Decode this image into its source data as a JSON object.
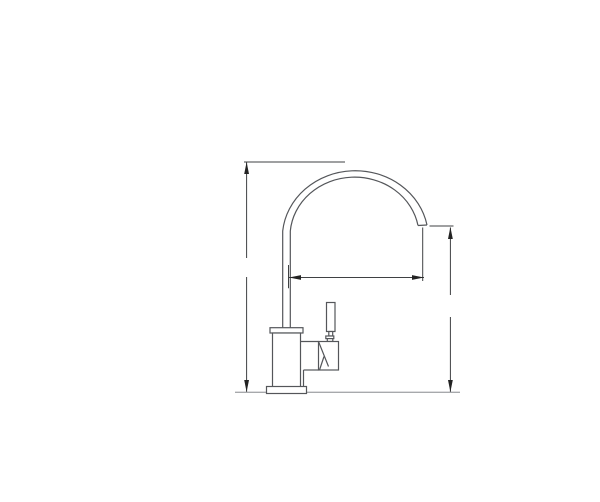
{
  "meta": {
    "description": "Technical line drawing (CAD elevation) of a single-lever gooseneck kitchen faucet shown in side view, standing on a counter line",
    "drawing_type": "cad-elevation",
    "visible_text": ""
  },
  "colors": {
    "background": "#ffffff",
    "outline": "#54565a",
    "dimension": "#3f4143",
    "arrow": "#232323",
    "ground": "#a7a9ac"
  },
  "drawing": {
    "parts": [
      "gooseneck-spout-arc",
      "spout-tip-outlet",
      "vertical-riser-pipe",
      "body-top-flange",
      "faucet-body",
      "valve-housing",
      "lever-handle",
      "base-plate",
      "counter-ground-line"
    ],
    "dimensions": [
      {
        "name": "overall-height",
        "orientation": "vertical",
        "side": "left",
        "label": ""
      },
      {
        "name": "spout-reach",
        "orientation": "horizontal",
        "side": "middle",
        "label": ""
      },
      {
        "name": "spout-outlet-height",
        "orientation": "vertical",
        "side": "right",
        "label": ""
      }
    ]
  }
}
